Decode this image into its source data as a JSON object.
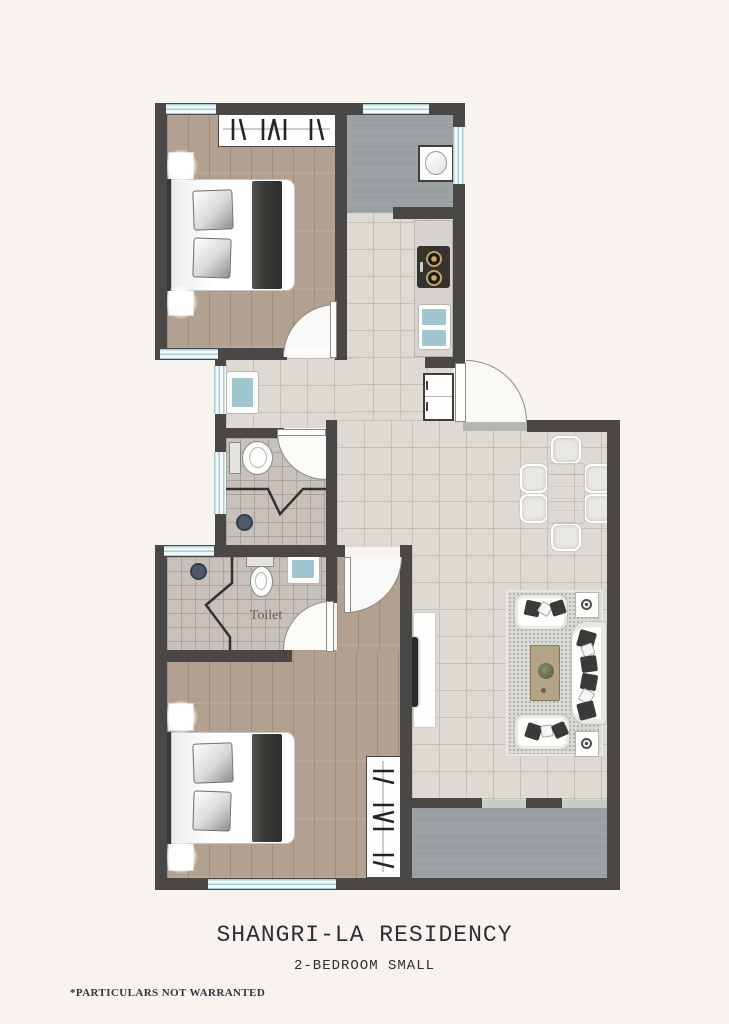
{
  "page": {
    "background": "#f7f4ef",
    "title": "SHANGRI-LA RESIDENCY",
    "subtitle": "2-BEDROOM SMALL",
    "disclaimer": "*PARTICULARS NOT WARRANTED"
  },
  "plan": {
    "labels": {
      "toilet": "Toilet"
    },
    "colors": {
      "wall": "#4a4846",
      "tile": "#dedad3",
      "tileLine": "#c5c0b8",
      "bathTile": "#c8c0ba",
      "bathTileLine": "#aba39d",
      "wood": "#b2a190",
      "utility": "#9ba0a3",
      "windowGlass": "#f2f9fa",
      "windowFrame": "#a9ced6",
      "fixtureTeal": "#a2c6cf",
      "doorArc": "#8b8b89",
      "furnitureDark": "#3b3a38",
      "counter": "#d7d4cf",
      "rug": "#d9d9d5",
      "tableTan": "#b3a584",
      "titleText": "#2e2d36",
      "labelText": "#6a625b"
    }
  }
}
